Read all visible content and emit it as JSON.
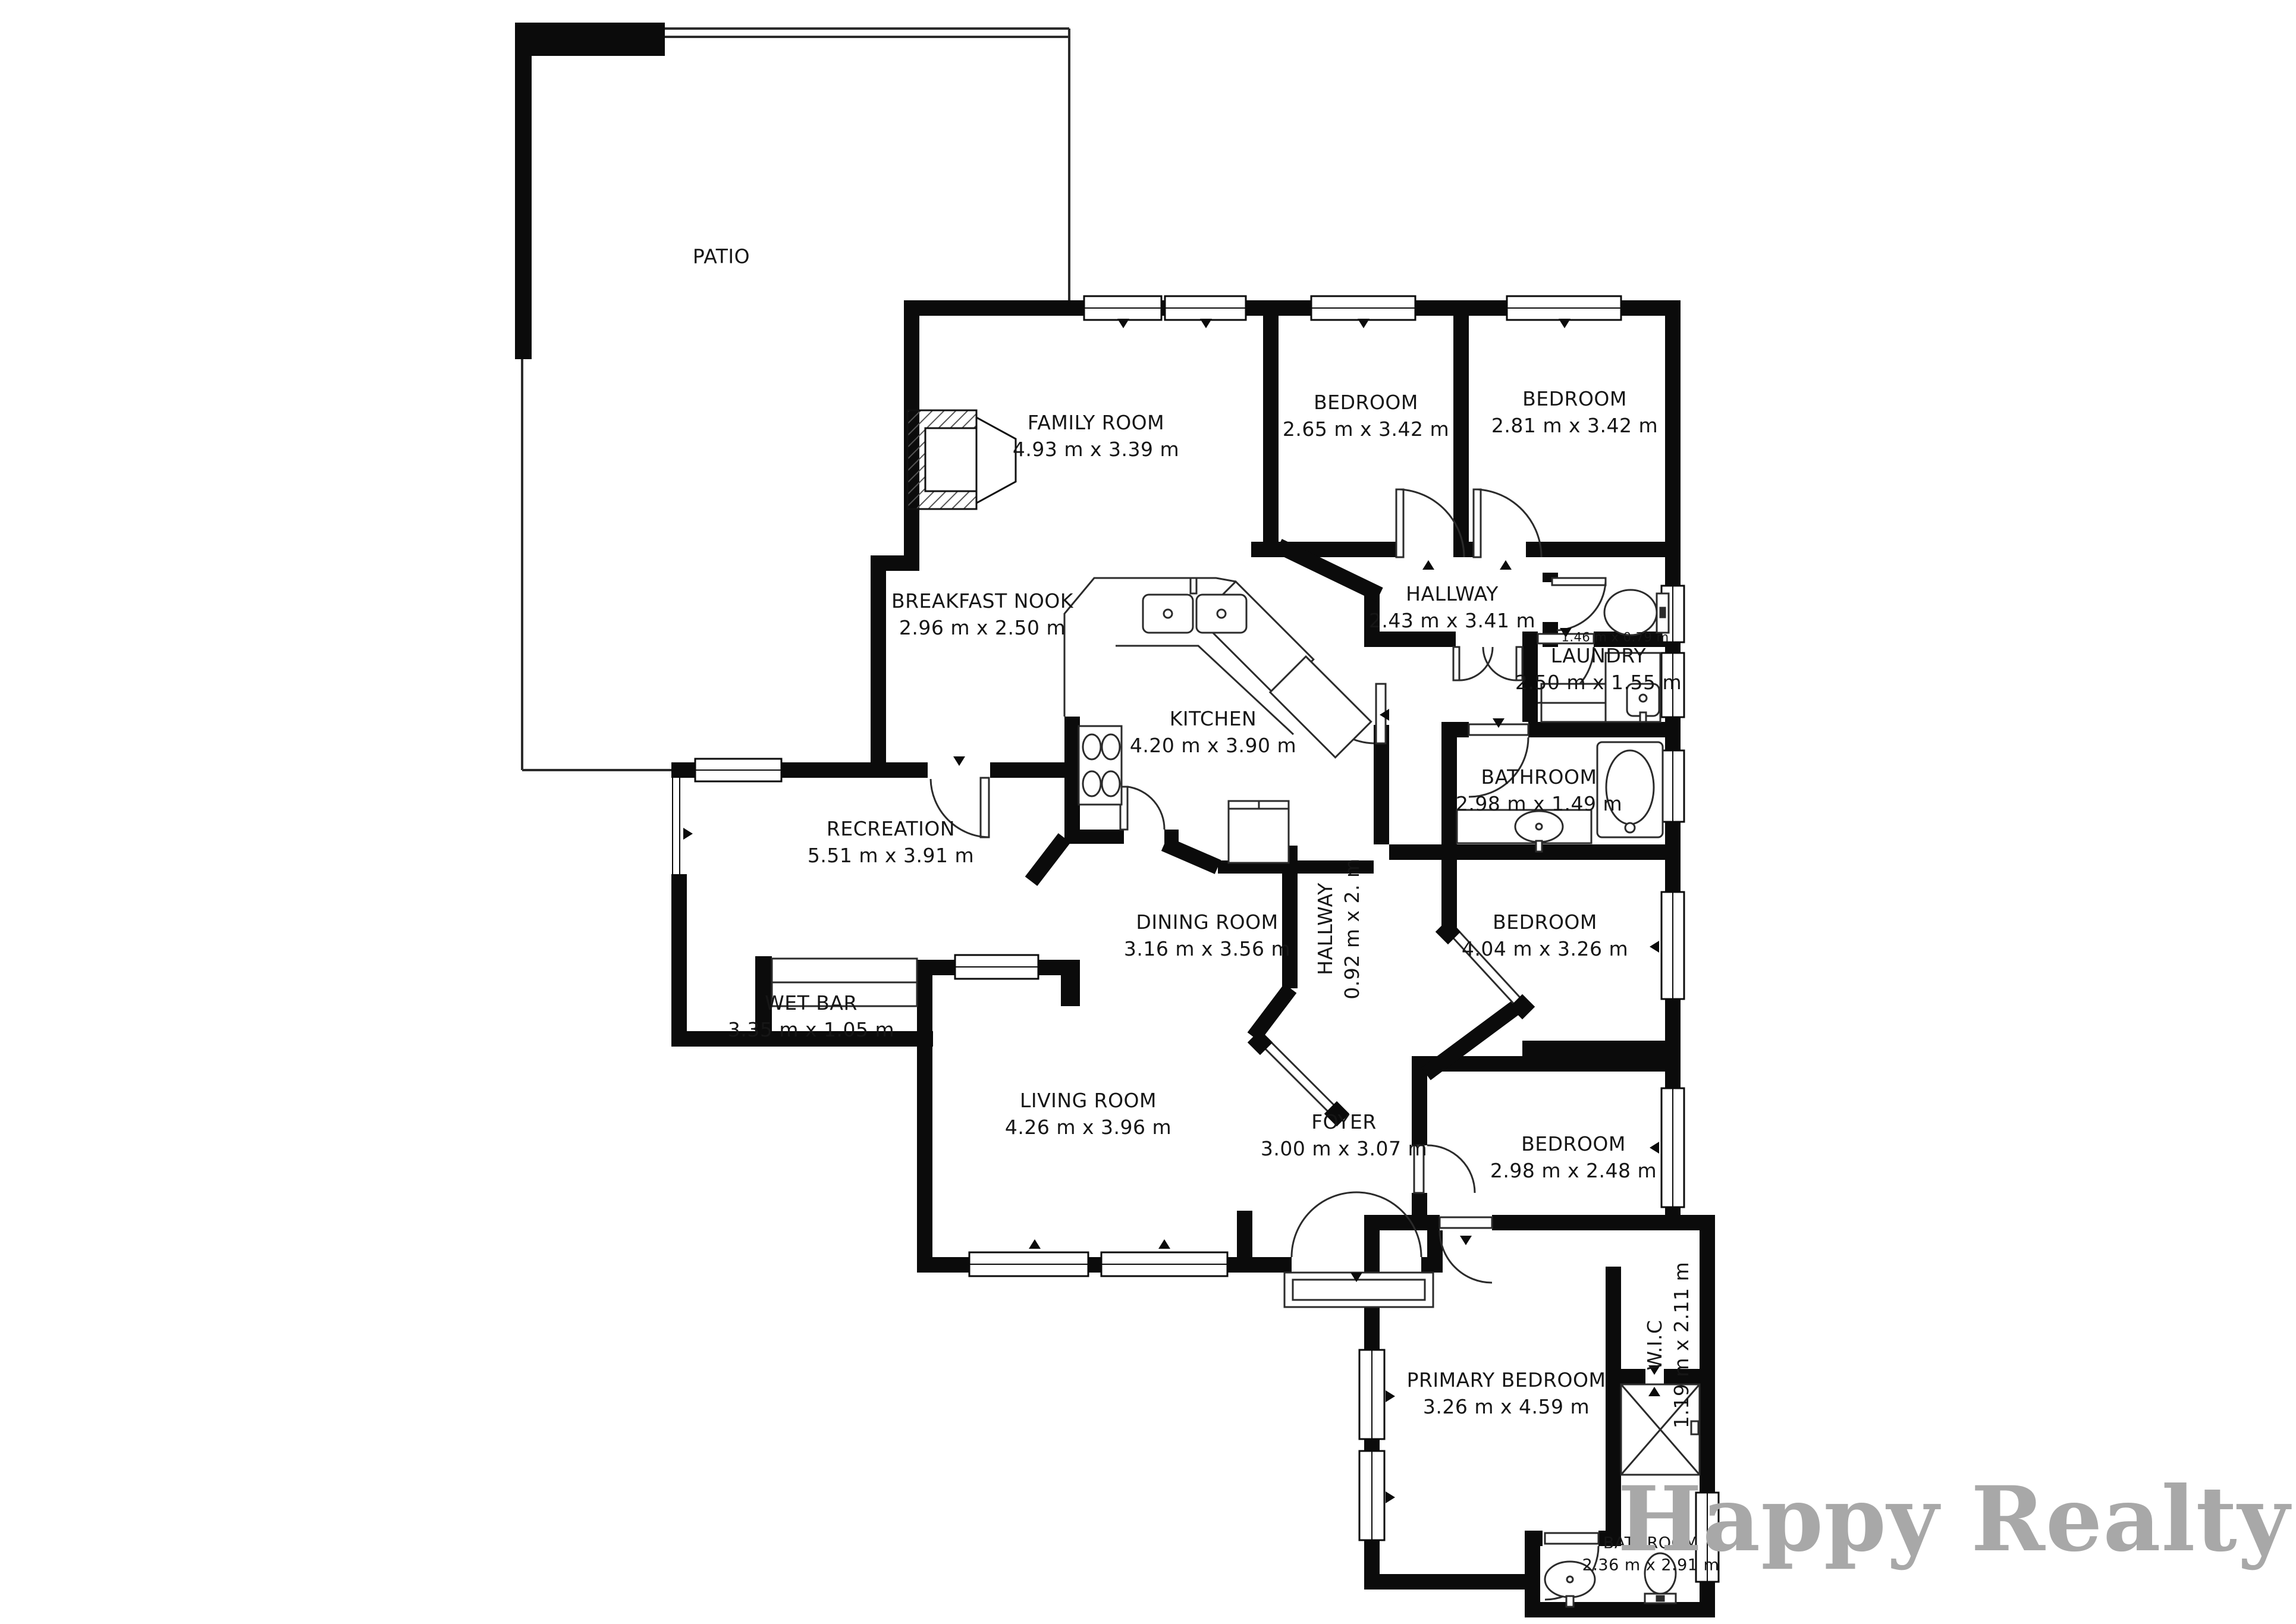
{
  "branding": {
    "logo_text": "Happy Realty",
    "logo_color": "#a8a8a8"
  },
  "plan_colors": {
    "walls": "#0b0b0b",
    "lines": "#2b2b2b",
    "background": "#ffffff"
  },
  "rooms": [
    {
      "name": "PATIO",
      "dims": ""
    },
    {
      "name": "FAMILY ROOM",
      "dims": "4.93 m x 3.39 m"
    },
    {
      "name": "BEDROOM",
      "dims": "2.65 m x 3.42 m"
    },
    {
      "name": "BEDROOM",
      "dims": "2.81 m x 3.42 m"
    },
    {
      "name": "BREAKFAST NOOK",
      "dims": "2.96 m x 2.50 m"
    },
    {
      "name": "HALLWAY",
      "dims": "2.43 m x 3.41 m"
    },
    {
      "name": "",
      "dims": "1.46 m x 0.79 m"
    },
    {
      "name": "LAUNDRY",
      "dims": "2.50 m x 1.55 m"
    },
    {
      "name": "KITCHEN",
      "dims": "4.20 m x 3.90 m"
    },
    {
      "name": "BATHROOM",
      "dims": "2.98 m x 1.49 m"
    },
    {
      "name": "RECREATION",
      "dims": "5.51 m x 3.91 m"
    },
    {
      "name": "DINING ROOM",
      "dims": "3.16 m x 3.56 m"
    },
    {
      "name": "HALLWAY",
      "dims": "0.92 m x 2. m"
    },
    {
      "name": "BEDROOM",
      "dims": "4.04 m x 3.26 m"
    },
    {
      "name": "WET BAR",
      "dims": "3.35 m x 1.05 m"
    },
    {
      "name": "LIVING ROOM",
      "dims": "4.26 m x 3.96 m"
    },
    {
      "name": "FOYER",
      "dims": "3.00 m x 3.07 m"
    },
    {
      "name": "BEDROOM",
      "dims": "2.98 m x 2.48 m"
    },
    {
      "name": "PRIMARY BEDROOM",
      "dims": "3.26 m x 4.59 m"
    },
    {
      "name": "W.I.C",
      "dims": "1.19 m x 2.11 m"
    },
    {
      "name": "BATHROOM",
      "dims": "2.36 m x 2.91 m"
    }
  ]
}
